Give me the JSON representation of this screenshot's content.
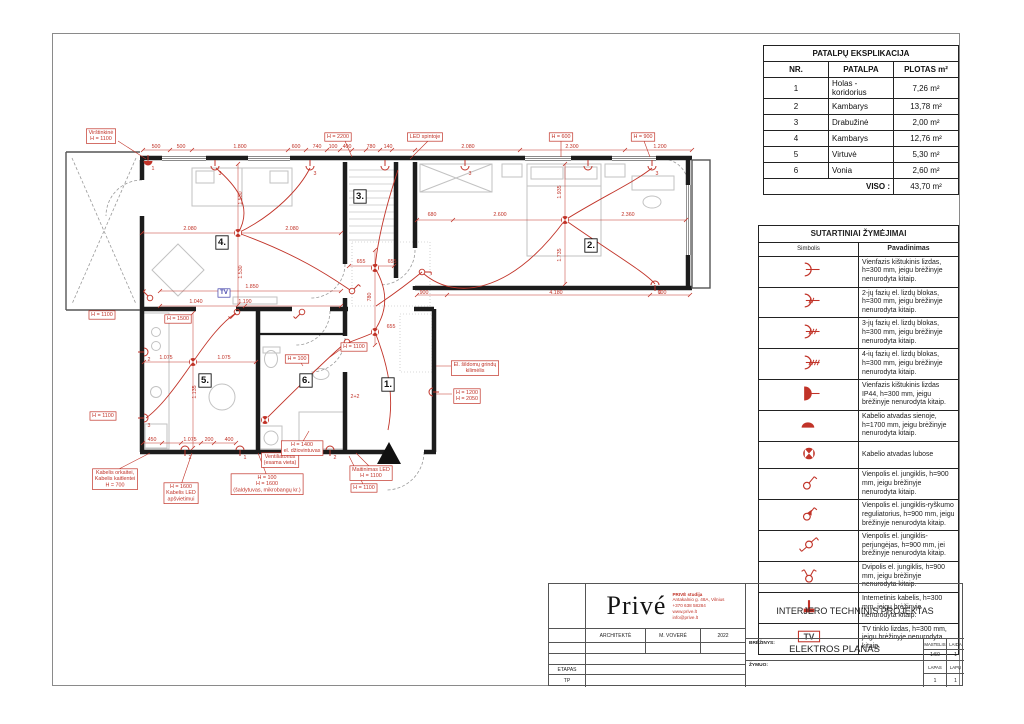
{
  "colors": {
    "accent_red": "#c13328",
    "wall_black": "#1c1c1c",
    "furniture_gray": "#c2c2c2",
    "tv_blue": "#3d3da8"
  },
  "explication": {
    "title": "PATALPŲ EKSPLIKACIJA",
    "headers": [
      "NR.",
      "PATALPA",
      "PLOTAS m²"
    ],
    "rows": [
      [
        "1",
        "Holas - koridorius",
        "7,26 m²"
      ],
      [
        "2",
        "Kambarys",
        "13,78 m²"
      ],
      [
        "3",
        "Drabužinė",
        "2,00 m²"
      ],
      [
        "4",
        "Kambarys",
        "12,76 m²"
      ],
      [
        "5",
        "Virtuvė",
        "5,30 m²"
      ],
      [
        "6",
        "Vonia",
        "2,60 m²"
      ]
    ],
    "total_label": "VISO :",
    "total_value": "43,70 m²"
  },
  "legend": {
    "title": "SUTARTINIAI ŽYMĖJIMAI",
    "symbol_header": "Simbolis",
    "name_header": "Pavadinimas",
    "tv_glyph": "TV",
    "rows": [
      {
        "symbol": "socket-1",
        "text": "Vienfazis kištukinis lizdas, h=300 mm, jeigu brėžinyje nenurodyta kitaip."
      },
      {
        "symbol": "socket-2",
        "text": "2-jų fazių el. lizdų blokas, h=300 mm, jeigu brėžinyje nenurodyta kitaip."
      },
      {
        "symbol": "socket-3",
        "text": "3-jų fazių el. lizdų blokas, h=300 mm, jeigu brėžinyje nenurodyta kitaip."
      },
      {
        "symbol": "socket-4",
        "text": "4-ių fazių el. lizdų blokas, h=300 mm, jeigu brėžinyje nenurodyta kitaip."
      },
      {
        "symbol": "socket-ip44",
        "text": "Vienfazis kištukinis lizdas IP44, h=300 mm, jeigu brėžinyje nenurodyta kitaip."
      },
      {
        "symbol": "cable-wall",
        "text": "Kabelio atvadas sienoje, h=1700 mm, jeigu brėžinyje nenurodyta kitaip."
      },
      {
        "symbol": "cable-ceiling",
        "text": "Kabelio atvadas lubose"
      },
      {
        "symbol": "switch-single",
        "text": "Vienpolis el. jungiklis, h=900 mm, jeigu brėžinyje nenurodyta kitaip."
      },
      {
        "symbol": "dimmer",
        "text": "Vienpolis el. jungiklis-ryškumo reguliatorius, h=900 mm, jeigu brėžinyje nenurodyta kitaip."
      },
      {
        "symbol": "switch-2way",
        "text": "Vienpolis el. jungiklis-perjungėjas, h=900 mm, jei brėžinyje nenurodyta kitaip."
      },
      {
        "symbol": "switch-2pole",
        "text": "Dvipolis el. jungiklis, h=900 mm, jeigu brėžinyje nenurodyta kitaip."
      },
      {
        "symbol": "internet",
        "text": "Internetinis kabelis, h=300 mm, jeigu brėžinyje nenurodyta kitaip."
      },
      {
        "symbol": "tv",
        "text": "TV tinklo lizdas, h=300 mm, jeigu brėžinyje nenurodyta kitaip."
      }
    ]
  },
  "title_block": {
    "logo": "Privé",
    "studio_lines": [
      "PRIVĖ studija",
      "Antakalnio g. 48A, Vilnius",
      "+370 638 58284",
      "www.prive.lt",
      "info@prive.lt"
    ],
    "architect_label": "ARCHITEKTĖ",
    "architect_name": "M. VOVERĖ",
    "year": "2022",
    "project_title": "INTERJERO TECHNINIS PROJEKTAS",
    "drawing_label": "BRĖŽINYS:",
    "drawing_title": "ELEKTROS PLANAS",
    "scale_label": "MASTELIS",
    "scale_value": "1:50",
    "laida_label": "LAIDA",
    "laida_value": "1",
    "zymuo_label": "ŽYMUO:",
    "lapas_label": "LAPAS",
    "lapas_value": "1",
    "lapu_label": "LAPŲ",
    "lapu_value": "1",
    "etapas_label": "ETAPAS",
    "etapas_value": "TP"
  },
  "plan": {
    "texts": [
      {
        "t": [
          "Virštinkinė",
          "H = 1100"
        ],
        "x": 101,
        "y": 134,
        "c": "boxr",
        "b": true
      },
      {
        "t": "H = 2200",
        "x": 338,
        "y": 138,
        "c": "boxr",
        "b": true
      },
      {
        "t": "LED spintoje",
        "x": 425,
        "y": 138,
        "c": "boxr",
        "b": true
      },
      {
        "t": "H = 600",
        "x": 561,
        "y": 138,
        "c": "boxr",
        "b": true
      },
      {
        "t": "H = 900",
        "x": 643,
        "y": 138,
        "c": "boxr",
        "b": true
      },
      {
        "t": "500",
        "x": 156,
        "y": 148,
        "c": "dim"
      },
      {
        "t": "500",
        "x": 181,
        "y": 148,
        "c": "dim"
      },
      {
        "t": "1.800",
        "x": 240,
        "y": 148,
        "c": "dim"
      },
      {
        "t": "600",
        "x": 296,
        "y": 148,
        "c": "dim"
      },
      {
        "t": "740",
        "x": 317,
        "y": 148,
        "c": "dim"
      },
      {
        "t": "100",
        "x": 333,
        "y": 148,
        "c": "dim"
      },
      {
        "t": "400",
        "x": 347,
        "y": 148,
        "c": "dim"
      },
      {
        "t": "780",
        "x": 371,
        "y": 148,
        "c": "dim"
      },
      {
        "t": "140",
        "x": 388,
        "y": 148,
        "c": "dim"
      },
      {
        "t": "2.080",
        "x": 468,
        "y": 148,
        "c": "dim"
      },
      {
        "t": "2.300",
        "x": 572,
        "y": 148,
        "c": "dim"
      },
      {
        "t": "1.200",
        "x": 660,
        "y": 148,
        "c": "dim"
      },
      {
        "t": "H = 1100",
        "x": 102,
        "y": 316,
        "c": "boxr",
        "b": true
      },
      {
        "t": "H = 1500",
        "x": 178,
        "y": 320,
        "c": "boxr",
        "b": true
      },
      {
        "t": "H = 1100",
        "x": 103,
        "y": 417,
        "c": "boxr",
        "b": true
      },
      {
        "t": "TV",
        "x": 224,
        "y": 294,
        "c": "tv",
        "b": true
      },
      {
        "t": "1.850",
        "x": 252,
        "y": 288,
        "c": "dim"
      },
      {
        "t": "1.040",
        "x": 196,
        "y": 303,
        "c": "dim"
      },
      {
        "t": "1.190",
        "x": 245,
        "y": 303,
        "c": "dim"
      },
      {
        "t": "2.080",
        "x": 190,
        "y": 230,
        "c": "dim"
      },
      {
        "t": "2.080",
        "x": 292,
        "y": 230,
        "c": "dim"
      },
      {
        "t": "1.530",
        "x": 242,
        "y": 198,
        "c": "dim",
        "r": -90
      },
      {
        "t": "1.530",
        "x": 242,
        "y": 272,
        "c": "dim",
        "r": -90
      },
      {
        "t": "4.",
        "x": 222,
        "y": 245,
        "c": "room",
        "b": true
      },
      {
        "t": "3.",
        "x": 360,
        "y": 199,
        "c": "room",
        "b": true
      },
      {
        "t": "2.",
        "x": 591,
        "y": 248,
        "c": "room",
        "b": true
      },
      {
        "t": "680",
        "x": 432,
        "y": 216,
        "c": "dim"
      },
      {
        "t": "2.600",
        "x": 500,
        "y": 216,
        "c": "dim"
      },
      {
        "t": "2.360",
        "x": 628,
        "y": 216,
        "c": "dim"
      },
      {
        "t": "1.935",
        "x": 561,
        "y": 192,
        "c": "dim",
        "r": -90
      },
      {
        "t": "1.735",
        "x": 561,
        "y": 255,
        "c": "dim",
        "r": -90
      },
      {
        "t": "655",
        "x": 361,
        "y": 263,
        "c": "dim"
      },
      {
        "t": "655",
        "x": 392,
        "y": 263,
        "c": "dim"
      },
      {
        "t": "780",
        "x": 371,
        "y": 297,
        "c": "dim",
        "r": -90
      },
      {
        "t": "655",
        "x": 391,
        "y": 328,
        "c": "dim"
      },
      {
        "t": "900",
        "x": 424,
        "y": 294,
        "c": "dim"
      },
      {
        "t": "4.180",
        "x": 556,
        "y": 294,
        "c": "dim"
      },
      {
        "t": "600",
        "x": 662,
        "y": 294,
        "c": "dim"
      },
      {
        "t": "450",
        "x": 152,
        "y": 441,
        "c": "dim"
      },
      {
        "t": "1.075",
        "x": 190,
        "y": 441,
        "c": "dim"
      },
      {
        "t": "200",
        "x": 209,
        "y": 441,
        "c": "dim"
      },
      {
        "t": "400",
        "x": 229,
        "y": 441,
        "c": "dim"
      },
      {
        "t": "1.075",
        "x": 166,
        "y": 359,
        "c": "dim"
      },
      {
        "t": "1.075",
        "x": 224,
        "y": 359,
        "c": "dim"
      },
      {
        "t": "1.135",
        "x": 196,
        "y": 392,
        "c": "dim",
        "r": -90
      },
      {
        "t": "5.",
        "x": 205,
        "y": 383,
        "c": "room",
        "b": true
      },
      {
        "t": "6.",
        "x": 306,
        "y": 383,
        "c": "room",
        "b": true
      },
      {
        "t": "1.",
        "x": 388,
        "y": 387,
        "c": "room",
        "b": true
      },
      {
        "t": "2+2",
        "x": 355,
        "y": 398,
        "c": "dim"
      },
      {
        "t": "H = 1100",
        "x": 354,
        "y": 348,
        "c": "boxr",
        "b": true
      },
      {
        "t": "H = 100",
        "x": 297,
        "y": 360,
        "c": "boxr",
        "b": true
      },
      {
        "t": [
          "El. šildomų grindų",
          "kilimėlis"
        ],
        "x": 475,
        "y": 366,
        "c": "boxr",
        "b": true
      },
      {
        "t": [
          "H = 1200",
          "H = 2050"
        ],
        "x": 467,
        "y": 394,
        "c": "boxr",
        "b": true
      },
      {
        "t": [
          "Kabelis orkaitei,",
          "Kabelis kaitlentei",
          "H = 700"
        ],
        "x": 115,
        "y": 474,
        "c": "boxr",
        "b": true
      },
      {
        "t": [
          "H = 1600",
          "Kabelis LED",
          "apšvietimui"
        ],
        "x": 181,
        "y": 488,
        "c": "boxr",
        "b": true
      },
      {
        "t": [
          "H = 100",
          "H = 1600",
          "(šaldytuvas, mikrobangų kr.)"
        ],
        "x": 267,
        "y": 479,
        "c": "boxr",
        "b": true
      },
      {
        "t": [
          "Ventiliatorius",
          "(esama vieta)"
        ],
        "x": 280,
        "y": 458,
        "c": "boxr",
        "b": true
      },
      {
        "t": [
          "H = 1400",
          "el. džiovintuvas"
        ],
        "x": 302,
        "y": 446,
        "c": "boxr",
        "b": true
      },
      {
        "t": [
          "Maitinimas LED",
          "H = 1100"
        ],
        "x": 371,
        "y": 471,
        "c": "boxr",
        "b": true
      },
      {
        "t": "H = 1100",
        "x": 364,
        "y": 489,
        "c": "boxr",
        "b": true
      }
    ],
    "symbols": {
      "dots": [
        [
          238,
          233
        ],
        [
          565,
          220
        ],
        [
          375,
          268
        ],
        [
          375,
          332
        ],
        [
          193,
          362
        ],
        [
          265,
          420
        ]
      ],
      "sockets": [
        {
          "x": 215,
          "y": 166,
          "r": 0,
          "n": "3"
        },
        {
          "x": 310,
          "y": 166,
          "r": 0,
          "n": "3"
        },
        {
          "x": 385,
          "y": 166,
          "r": 0,
          "n": ""
        },
        {
          "x": 465,
          "y": 166,
          "r": 0,
          "n": "3"
        },
        {
          "x": 588,
          "y": 166,
          "r": 0,
          "n": ""
        },
        {
          "x": 652,
          "y": 166,
          "r": 0,
          "n": "3"
        },
        {
          "x": 148,
          "y": 161,
          "r": 0,
          "n": "1",
          "f": true
        },
        {
          "x": 185,
          "y": 450,
          "r": 180,
          "n": "2"
        },
        {
          "x": 240,
          "y": 450,
          "r": 180,
          "n": "1"
        },
        {
          "x": 330,
          "y": 450,
          "r": 180,
          "n": "2"
        },
        {
          "x": 144,
          "y": 352,
          "r": 270,
          "n": "2"
        },
        {
          "x": 144,
          "y": 418,
          "r": 270,
          "n": "3"
        },
        {
          "x": 655,
          "y": 285,
          "r": 180,
          "n": "2"
        },
        {
          "x": 433,
          "y": 392,
          "r": 90,
          "n": ""
        }
      ],
      "switches": [
        [
          352,
          291,
          0
        ],
        [
          422,
          272,
          45
        ],
        [
          347,
          342,
          90
        ],
        [
          237,
          312,
          180
        ],
        [
          302,
          312,
          180
        ],
        [
          150,
          298,
          270
        ]
      ]
    }
  }
}
